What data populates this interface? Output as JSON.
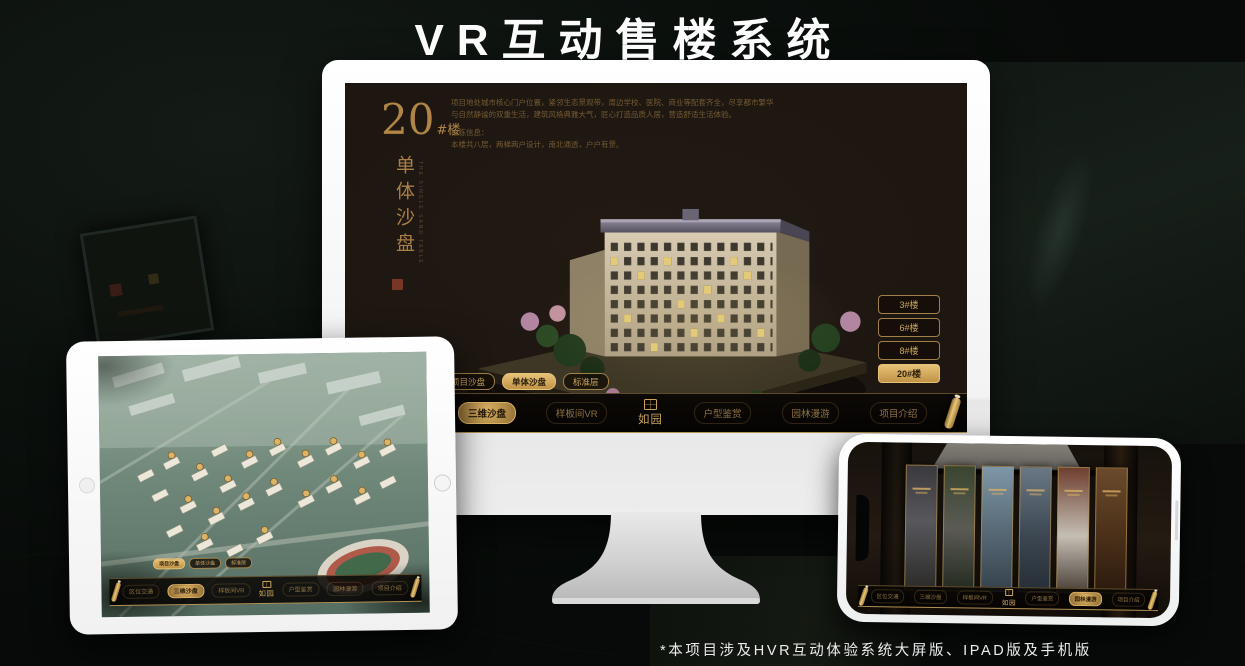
{
  "page": {
    "title": "VR互动售楼系统",
    "footnote": "*本项目涉及HVR互动体验系统大屏版、IPAD版及手机版"
  },
  "colors": {
    "gold": "#c9a257",
    "gold_bright": "#e7c277",
    "gold_dark": "#8f6d33",
    "screen_bg": "#1e1711",
    "selected_text": "#241807"
  },
  "nav": {
    "logo": "如园",
    "items": [
      "区位交通",
      "三维沙盘",
      "样板间VR",
      "户型鉴赏",
      "园林漫游",
      "项目介绍"
    ]
  },
  "sub_tabs": [
    "项目沙盘",
    "单体沙盘",
    "标准层"
  ],
  "monitor_screen": {
    "block_number": "20",
    "block_suffix": "#楼",
    "vertical_title": "单体沙盘",
    "vertical_subtitle": "THE SINGLE SAND TABLE",
    "description_lines": [
      "项目地处城市核心门户位置，紧邻生态景观带，周边学校、医院、商业等配套齐全，尽享都市繁华",
      "与自然静谧的双重生活，建筑风格典雅大气，匠心打造品质人居，营造舒适生活体验。",
      "楼栋信息：",
      "本楼共八层，两梯两户设计，南北通透，户户有景。"
    ],
    "floor_buttons": [
      "3#楼",
      "6#楼",
      "8#楼",
      "20#楼"
    ],
    "selected_floor": "20#楼",
    "selected_tab": "单体沙盘",
    "selected_nav": "三维沙盘"
  },
  "tablet_screen": {
    "selected_tab": "项目沙盘",
    "selected_nav": "三维沙盘"
  },
  "phone_screen": {
    "selected_nav": "园林漫游",
    "gallery_card_count": 6
  }
}
